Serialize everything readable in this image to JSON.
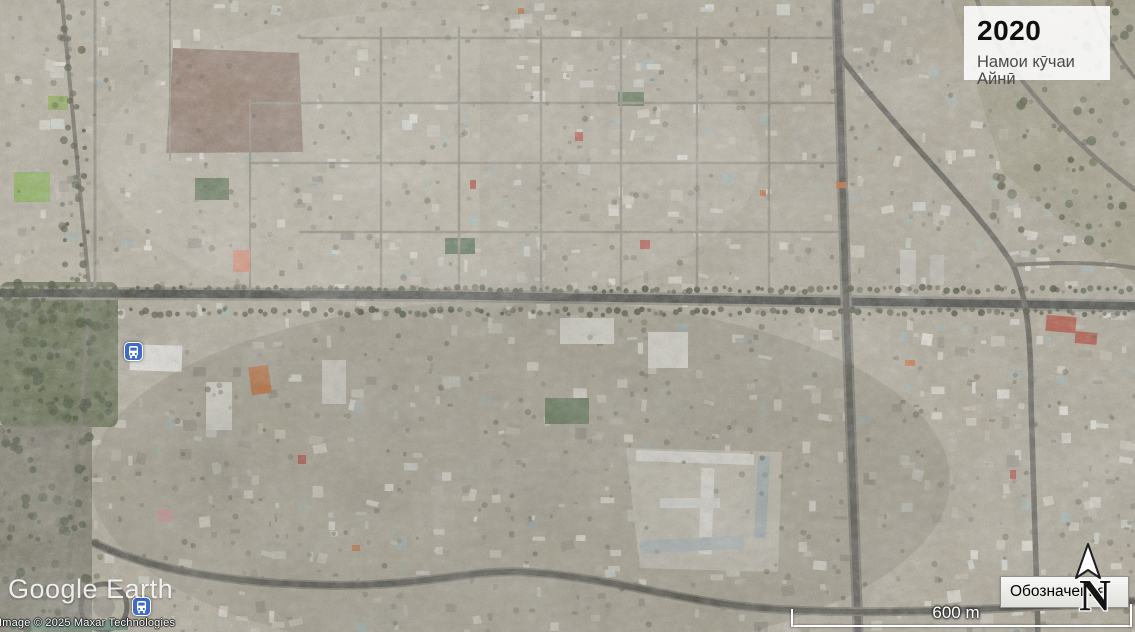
{
  "overlay_card": {
    "year": "2020",
    "caption": "Намои кӯчаи Айнӣ"
  },
  "branding": {
    "logo_text": "Google Earth",
    "copyright": "Image © 2025 Maxar Technologies"
  },
  "legend": {
    "label": "Обозначения"
  },
  "compass": {
    "label": "N"
  },
  "scale_bar": {
    "label": "600 m"
  },
  "markers": [
    {
      "type": "transit-station",
      "x": 134,
      "y": 352
    },
    {
      "type": "transit-station",
      "x": 142,
      "y": 607
    }
  ],
  "colors": {
    "marker_blue": "#3f6bc6",
    "card_bg": "rgba(255,255,255,0.87)"
  }
}
